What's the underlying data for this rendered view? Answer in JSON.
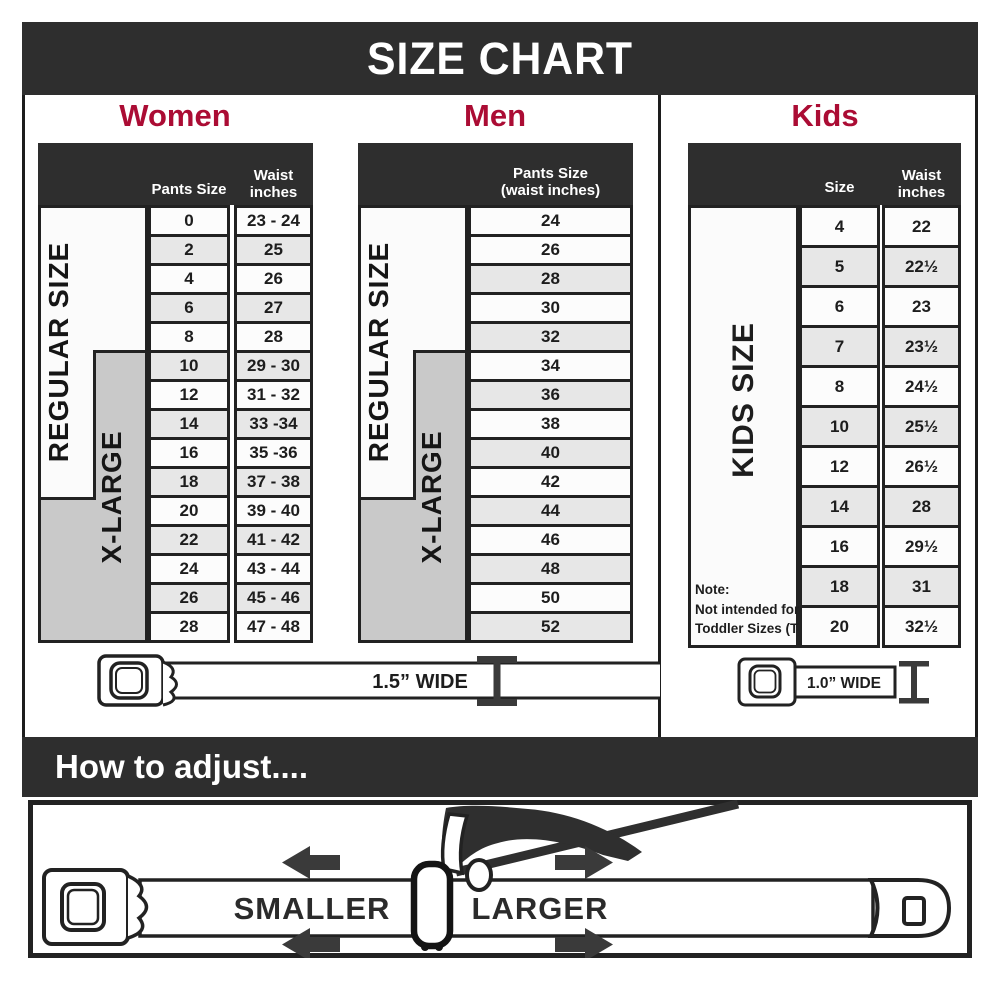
{
  "title": "SIZE CHART",
  "colors": {
    "dark_bar": "#2e2e2e",
    "accent_red": "#ab0c34",
    "xlarge_gray": "#c9c9c9",
    "row_alt_gray": "#e7e7e7"
  },
  "sections": {
    "women": {
      "heading": "Women",
      "col1_header": "Pants Size",
      "col2_header_line1": "Waist",
      "col2_header_line2": "inches",
      "regular_label": "REGULAR SIZE",
      "xlarge_label": "X-LARGE",
      "rows": [
        {
          "size": "0",
          "waist": "23 - 24"
        },
        {
          "size": "2",
          "waist": "25"
        },
        {
          "size": "4",
          "waist": "26"
        },
        {
          "size": "6",
          "waist": "27"
        },
        {
          "size": "8",
          "waist": "28"
        },
        {
          "size": "10",
          "waist": "29 - 30"
        },
        {
          "size": "12",
          "waist": "31 - 32"
        },
        {
          "size": "14",
          "waist": "33 -34"
        },
        {
          "size": "16",
          "waist": "35 -36"
        },
        {
          "size": "18",
          "waist": "37 - 38"
        },
        {
          "size": "20",
          "waist": "39 - 40"
        },
        {
          "size": "22",
          "waist": "41 - 42"
        },
        {
          "size": "24",
          "waist": "43 - 44"
        },
        {
          "size": "26",
          "waist": "45 - 46"
        },
        {
          "size": "28",
          "waist": "47 - 48"
        }
      ]
    },
    "men": {
      "heading": "Men",
      "col_header_line1": "Pants Size",
      "col_header_line2": "(waist inches)",
      "regular_label": "REGULAR SIZE",
      "xlarge_label": "X-LARGE",
      "rows": [
        {
          "size": "24"
        },
        {
          "size": "26"
        },
        {
          "size": "28"
        },
        {
          "size": "30"
        },
        {
          "size": "32"
        },
        {
          "size": "34"
        },
        {
          "size": "36"
        },
        {
          "size": "38"
        },
        {
          "size": "40"
        },
        {
          "size": "42"
        },
        {
          "size": "44"
        },
        {
          "size": "46"
        },
        {
          "size": "48"
        },
        {
          "size": "50"
        },
        {
          "size": "52"
        }
      ]
    },
    "kids": {
      "heading": "Kids",
      "col1_header": "Size",
      "col2_header_line1": "Waist",
      "col2_header_line2": "inches",
      "label": "KIDS SIZE",
      "note_line1": "Note:",
      "note_line2": "Not intended for",
      "note_line3": "Toddler Sizes (T)",
      "rows": [
        {
          "size": "4",
          "waist": "22"
        },
        {
          "size": "5",
          "waist": "22½"
        },
        {
          "size": "6",
          "waist": "23"
        },
        {
          "size": "7",
          "waist": "23½"
        },
        {
          "size": "8",
          "waist": "24½"
        },
        {
          "size": "10",
          "waist": "25½"
        },
        {
          "size": "12",
          "waist": "26½"
        },
        {
          "size": "14",
          "waist": "28"
        },
        {
          "size": "16",
          "waist": "29½"
        },
        {
          "size": "18",
          "waist": "31"
        },
        {
          "size": "20",
          "waist": "32½"
        }
      ]
    }
  },
  "belts": {
    "adult_width_label": "1.5” WIDE",
    "kids_width_label": "1.0” WIDE"
  },
  "how_to": {
    "heading": "How to adjust....",
    "smaller_label": "SMALLER",
    "larger_label": "LARGER"
  }
}
